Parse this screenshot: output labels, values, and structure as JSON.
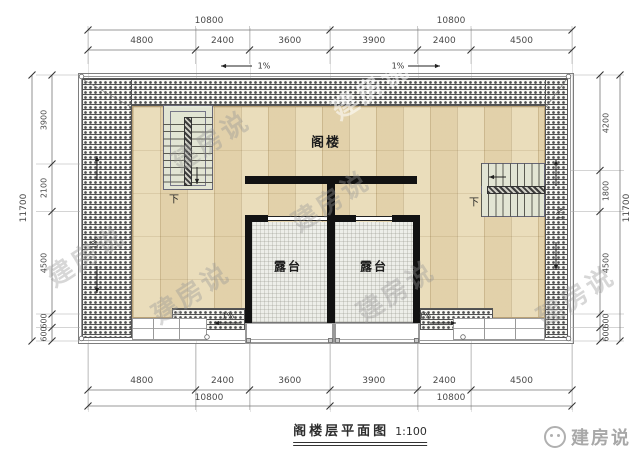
{
  "drawing": {
    "title": "阁楼层平面图",
    "scale": "1:100",
    "rooms": {
      "attic": "阁楼",
      "terrace_left": "露台",
      "terrace_right": "露台"
    },
    "stairs": {
      "left_down": "下",
      "right_down": "下"
    },
    "slope_label": "1%",
    "watermark": "建房说",
    "logo": "建房说"
  },
  "dimensions": {
    "top_overall": [
      "10800",
      "10800"
    ],
    "top_segments": [
      "4800",
      "2400",
      "3600",
      "3900",
      "2400",
      "4500"
    ],
    "left_total": "11700",
    "left_segments": [
      "3900",
      "2100",
      "4500",
      "600",
      "600"
    ],
    "right_total": "11700",
    "right_segments": [
      "4200",
      "1800",
      "4500",
      "600",
      "600"
    ],
    "bottom_segments": [
      "4800",
      "2400",
      "3600",
      "3900",
      "2400",
      "4500"
    ],
    "bottom_overall": [
      "10800",
      "10800"
    ]
  },
  "colors": {
    "wood_floor": "#e8d9b3",
    "tile_hatch": "#4f4f4f",
    "stair_fill": "#e2e5d4",
    "terrace_tile": "#edeee9",
    "wall": "#121212",
    "dimension_text": "#4a4a4a",
    "watermark_gray": "#969696"
  }
}
